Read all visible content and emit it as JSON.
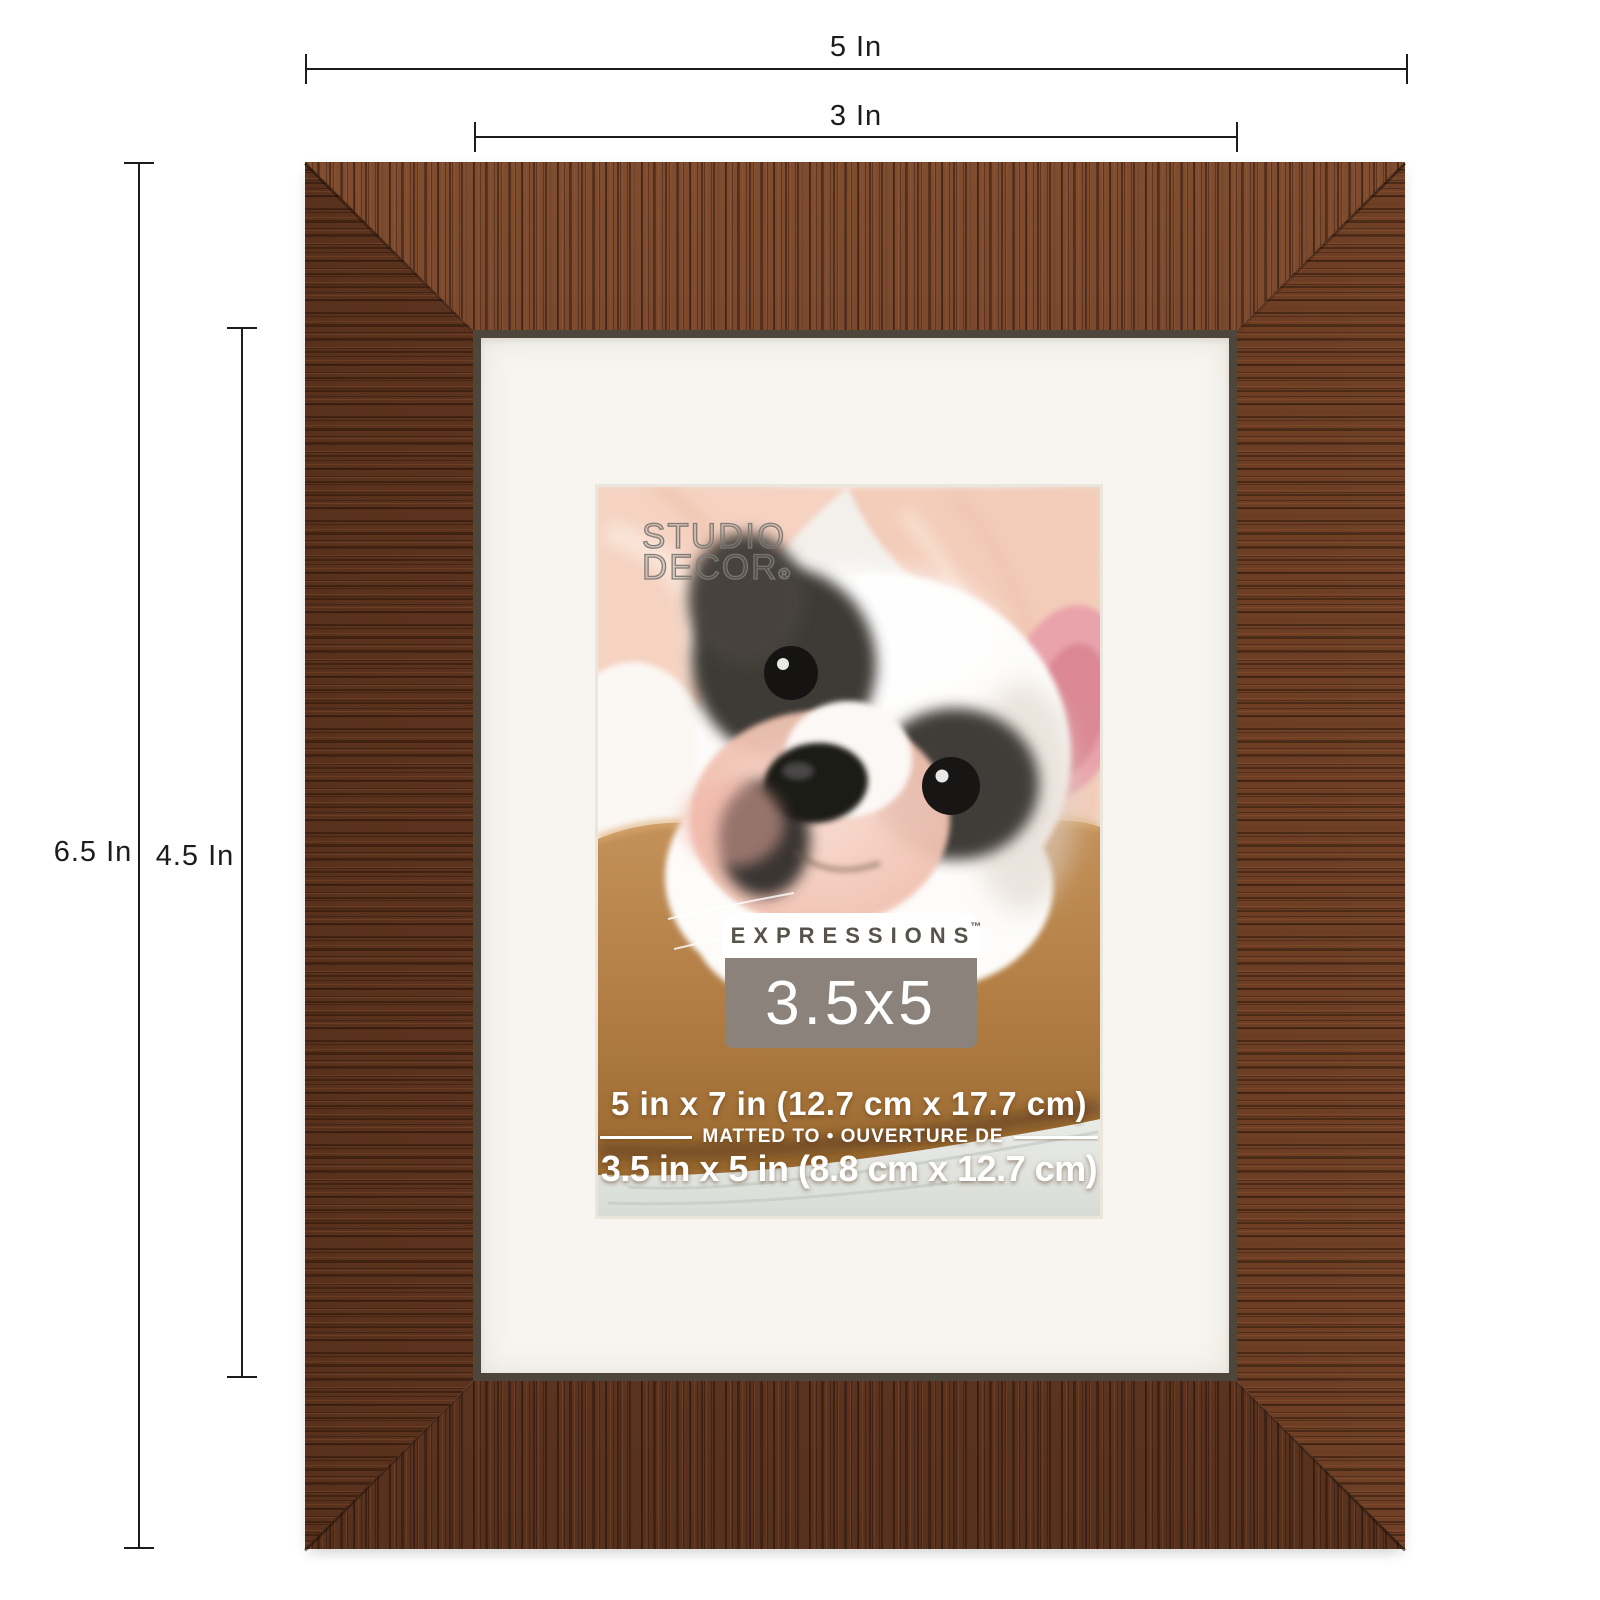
{
  "page": {
    "background": "#ffffff"
  },
  "dimension_annotations": {
    "outer_width": "5 In",
    "inner_width": "3 In",
    "outer_height": "6.5 In",
    "inner_height": "4.5 In",
    "line_color": "#1c1c1c"
  },
  "product": {
    "frame_wood_color": "#6e4027",
    "mat_color": "#f8f5f0",
    "insert_label": {
      "logo_line1": "STUDIO",
      "logo_line2": "DECOR",
      "logo_reg_mark": "®",
      "brand": "EXPRESSIONS",
      "brand_tm": "™",
      "size_badge": "3.5x5",
      "badge_bg": "#8b837b",
      "frame_size_line": "5 in x 7 in (12.7 cm x 17.7 cm)",
      "matted_line": "MATTED TO • OUVERTURE DE",
      "opening_size_line": "3.5 in x 5 in (8.8 cm x 12.7 cm)"
    }
  }
}
